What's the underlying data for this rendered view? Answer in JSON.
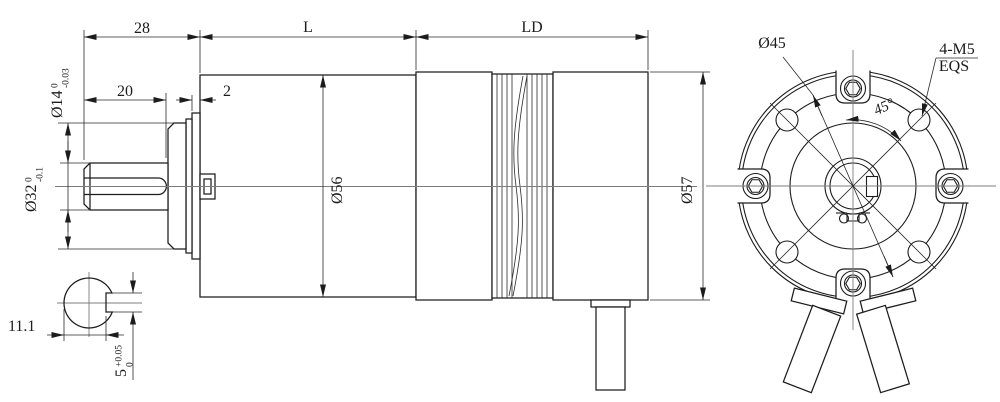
{
  "drawing": {
    "side_view": {
      "dim_28": "28",
      "dim_L": "L",
      "dim_LD": "LD",
      "dim_20": "20",
      "dim_2": "2",
      "shaft_dia": {
        "nom": "Ø14",
        "upper": "0",
        "lower": "-0.03"
      },
      "boss_dia": {
        "nom": "Ø32",
        "upper": "0",
        "lower": "-0.1"
      },
      "gearbox_dia": "Ø56",
      "motor_dia": "Ø57"
    },
    "shaft_section": {
      "dim_11_1": "11.1",
      "flat": {
        "nom": "5",
        "upper": "+0.05",
        "lower": "0"
      }
    },
    "front_view": {
      "bolt_circle_dia": "Ø45",
      "mount_holes": "4-M5",
      "mount_holes_note": "EQS",
      "hole_angle": "45°"
    }
  }
}
